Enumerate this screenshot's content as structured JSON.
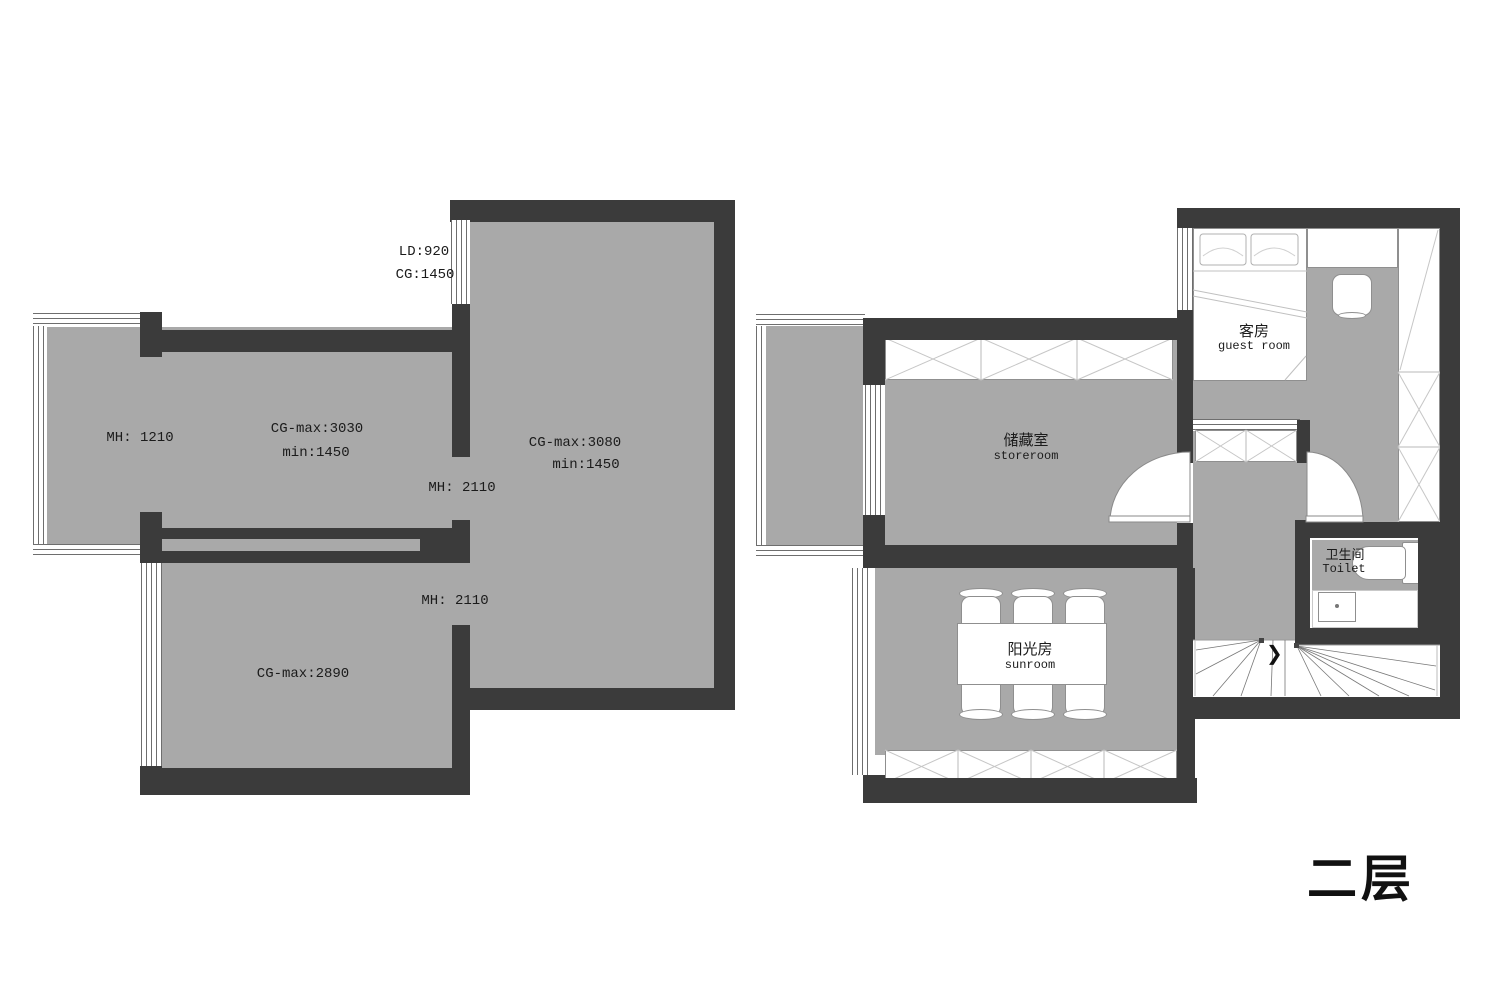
{
  "floor_title": "二层",
  "colors": {
    "wall": "#3b3b3b",
    "floor": "#a9a9a9",
    "line": "#8a8a8a",
    "text": "#1b1b1b"
  },
  "left_plan": {
    "labels": {
      "window_top_line1": "LD:920",
      "window_top_line2": "CG:1450",
      "balcony_height": "MH: 1210",
      "upper_room_line1": "CG-max:3030",
      "upper_room_line2": "min:1450",
      "main_room_line1": "CG-max:3080",
      "main_room_line2": "min:1450",
      "opening_upper": "MH: 2110",
      "opening_lower": "MH: 2110",
      "lower_room": "CG-max:2890"
    }
  },
  "right_plan": {
    "rooms": {
      "storeroom": {
        "zh": "储藏室",
        "en": "storeroom"
      },
      "sunroom": {
        "zh": "阳光房",
        "en": "sunroom"
      },
      "guest_room": {
        "zh": "客房",
        "en": "guest room"
      },
      "toilet": {
        "zh": "卫生间",
        "en": "Toilet"
      }
    }
  }
}
